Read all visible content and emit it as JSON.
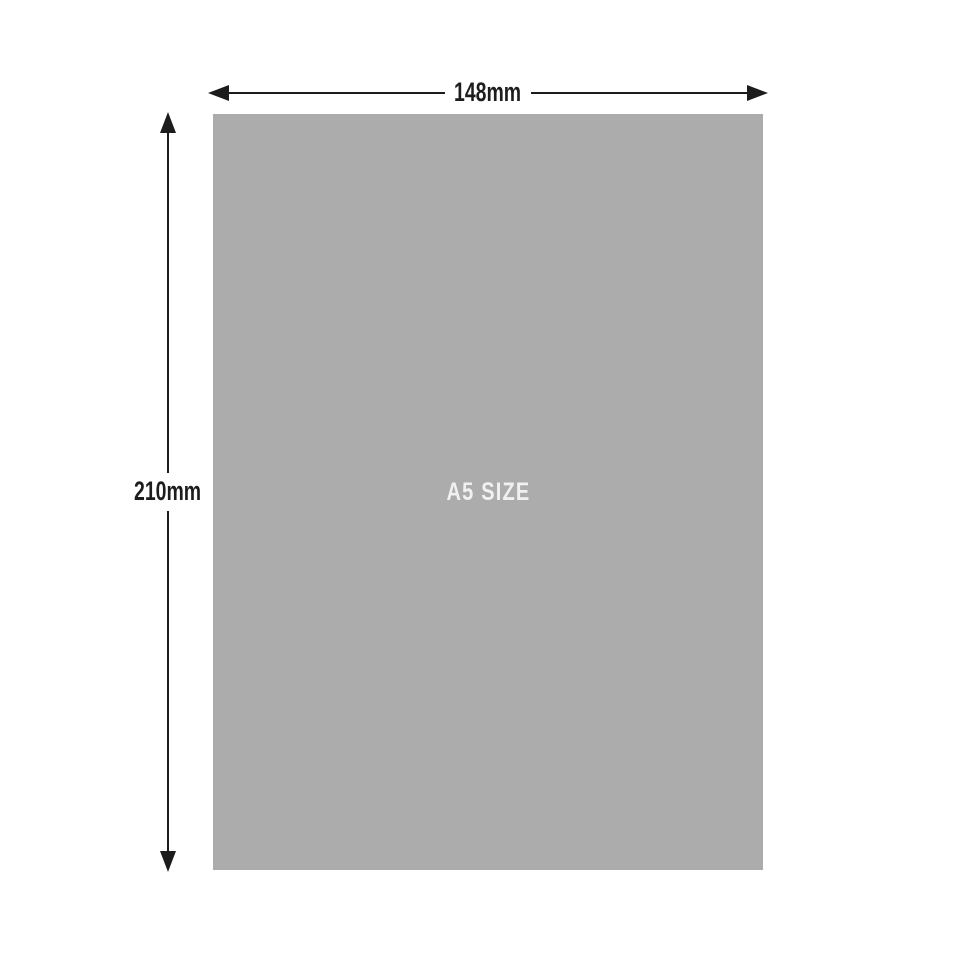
{
  "paper": {
    "size_label": "A5 SIZE"
  },
  "dimensions": {
    "width": {
      "label": "148mm"
    },
    "height": {
      "label": "210mm"
    }
  },
  "colors": {
    "background": "#ffffff",
    "paper": "#acacac",
    "line": "#1c1c1c",
    "dimension_text": "#1d1d1d",
    "size_text": "#f1f1f1"
  }
}
